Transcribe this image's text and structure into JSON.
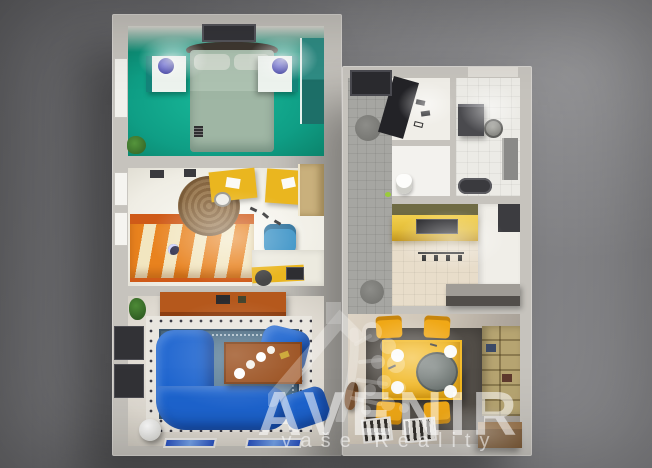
{
  "watermark": {
    "brand": "AVENIR",
    "tagline": "vaše Reality",
    "logo": "house-tree-logo"
  },
  "scene": {
    "description": "3D top-down architectural render of a furnished apartment floor plan on a grey studio background",
    "rooms": [
      {
        "name": "bedroom",
        "position": "top-left",
        "floor": "teal",
        "items": [
          "double-bed",
          "headboard",
          "nightstand-left",
          "nightstand-right",
          "blue-lamp-left",
          "blue-lamp-right",
          "ceiling-vent",
          "wardrobe",
          "door",
          "plant"
        ]
      },
      {
        "name": "kids-room",
        "position": "middle-left",
        "floor": "white",
        "items": [
          "striped-bed",
          "round-rug",
          "desk-top",
          "desk-right",
          "desk-chair",
          "blue-chair",
          "wardrobe",
          "work-desk",
          "laptop"
        ]
      },
      {
        "name": "living-room",
        "position": "bottom-left",
        "floor": "light",
        "items": [
          "orange-sideboard",
          "oriental-rug",
          "blue-corner-sofa",
          "blue-armchair",
          "blue-ottoman",
          "coffee-table",
          "candles",
          "tv-wall-panels",
          "white-sphere-lamp",
          "radiator-left",
          "radiator-right",
          "plant"
        ]
      },
      {
        "name": "entry-hall",
        "position": "top-center",
        "floor": "grey-tile",
        "items": [
          "entrance-door",
          "round-mat-top",
          "round-mat-bottom",
          "open-wardrobe",
          "shoes"
        ]
      },
      {
        "name": "bathroom",
        "position": "top-right",
        "floor": "white-tile",
        "items": [
          "washing-machine",
          "round-sink",
          "tall-cabinet",
          "bathtub"
        ]
      },
      {
        "name": "wc",
        "position": "center-right",
        "floor": "white",
        "items": [
          "toilet"
        ]
      },
      {
        "name": "kitchen",
        "position": "middle-right",
        "floor": "beige-tile",
        "items": [
          "gold-counter",
          "hob",
          "backsplash",
          "wall-hooks",
          "bar-counter",
          "white-cabinets",
          "dark-appliance"
        ]
      },
      {
        "name": "dining-room",
        "position": "bottom-right",
        "floor": "beige",
        "items": [
          "yellow-table",
          "round-tray",
          "plates",
          "yellow-chair x4",
          "dark-rug",
          "floor-vent x2",
          "bookshelf",
          "storage-box",
          "dog"
        ]
      }
    ]
  },
  "colors": {
    "background": "#757578",
    "wall": "#c6c3bd",
    "bedroom_teal": "#0f9e85",
    "sofa_blue": "#1d64cf",
    "rug_blue": "#5d8099",
    "accent_orange": "#b5581c",
    "accent_yellow": "#f0a816",
    "table_yellow": "#f2b71e",
    "counter_gold": "#e4be38",
    "bookshelf_tan": "#b6a471",
    "dining_rug": "#56514b",
    "watermark_white": "rgba(255,255,255,0.55)"
  }
}
